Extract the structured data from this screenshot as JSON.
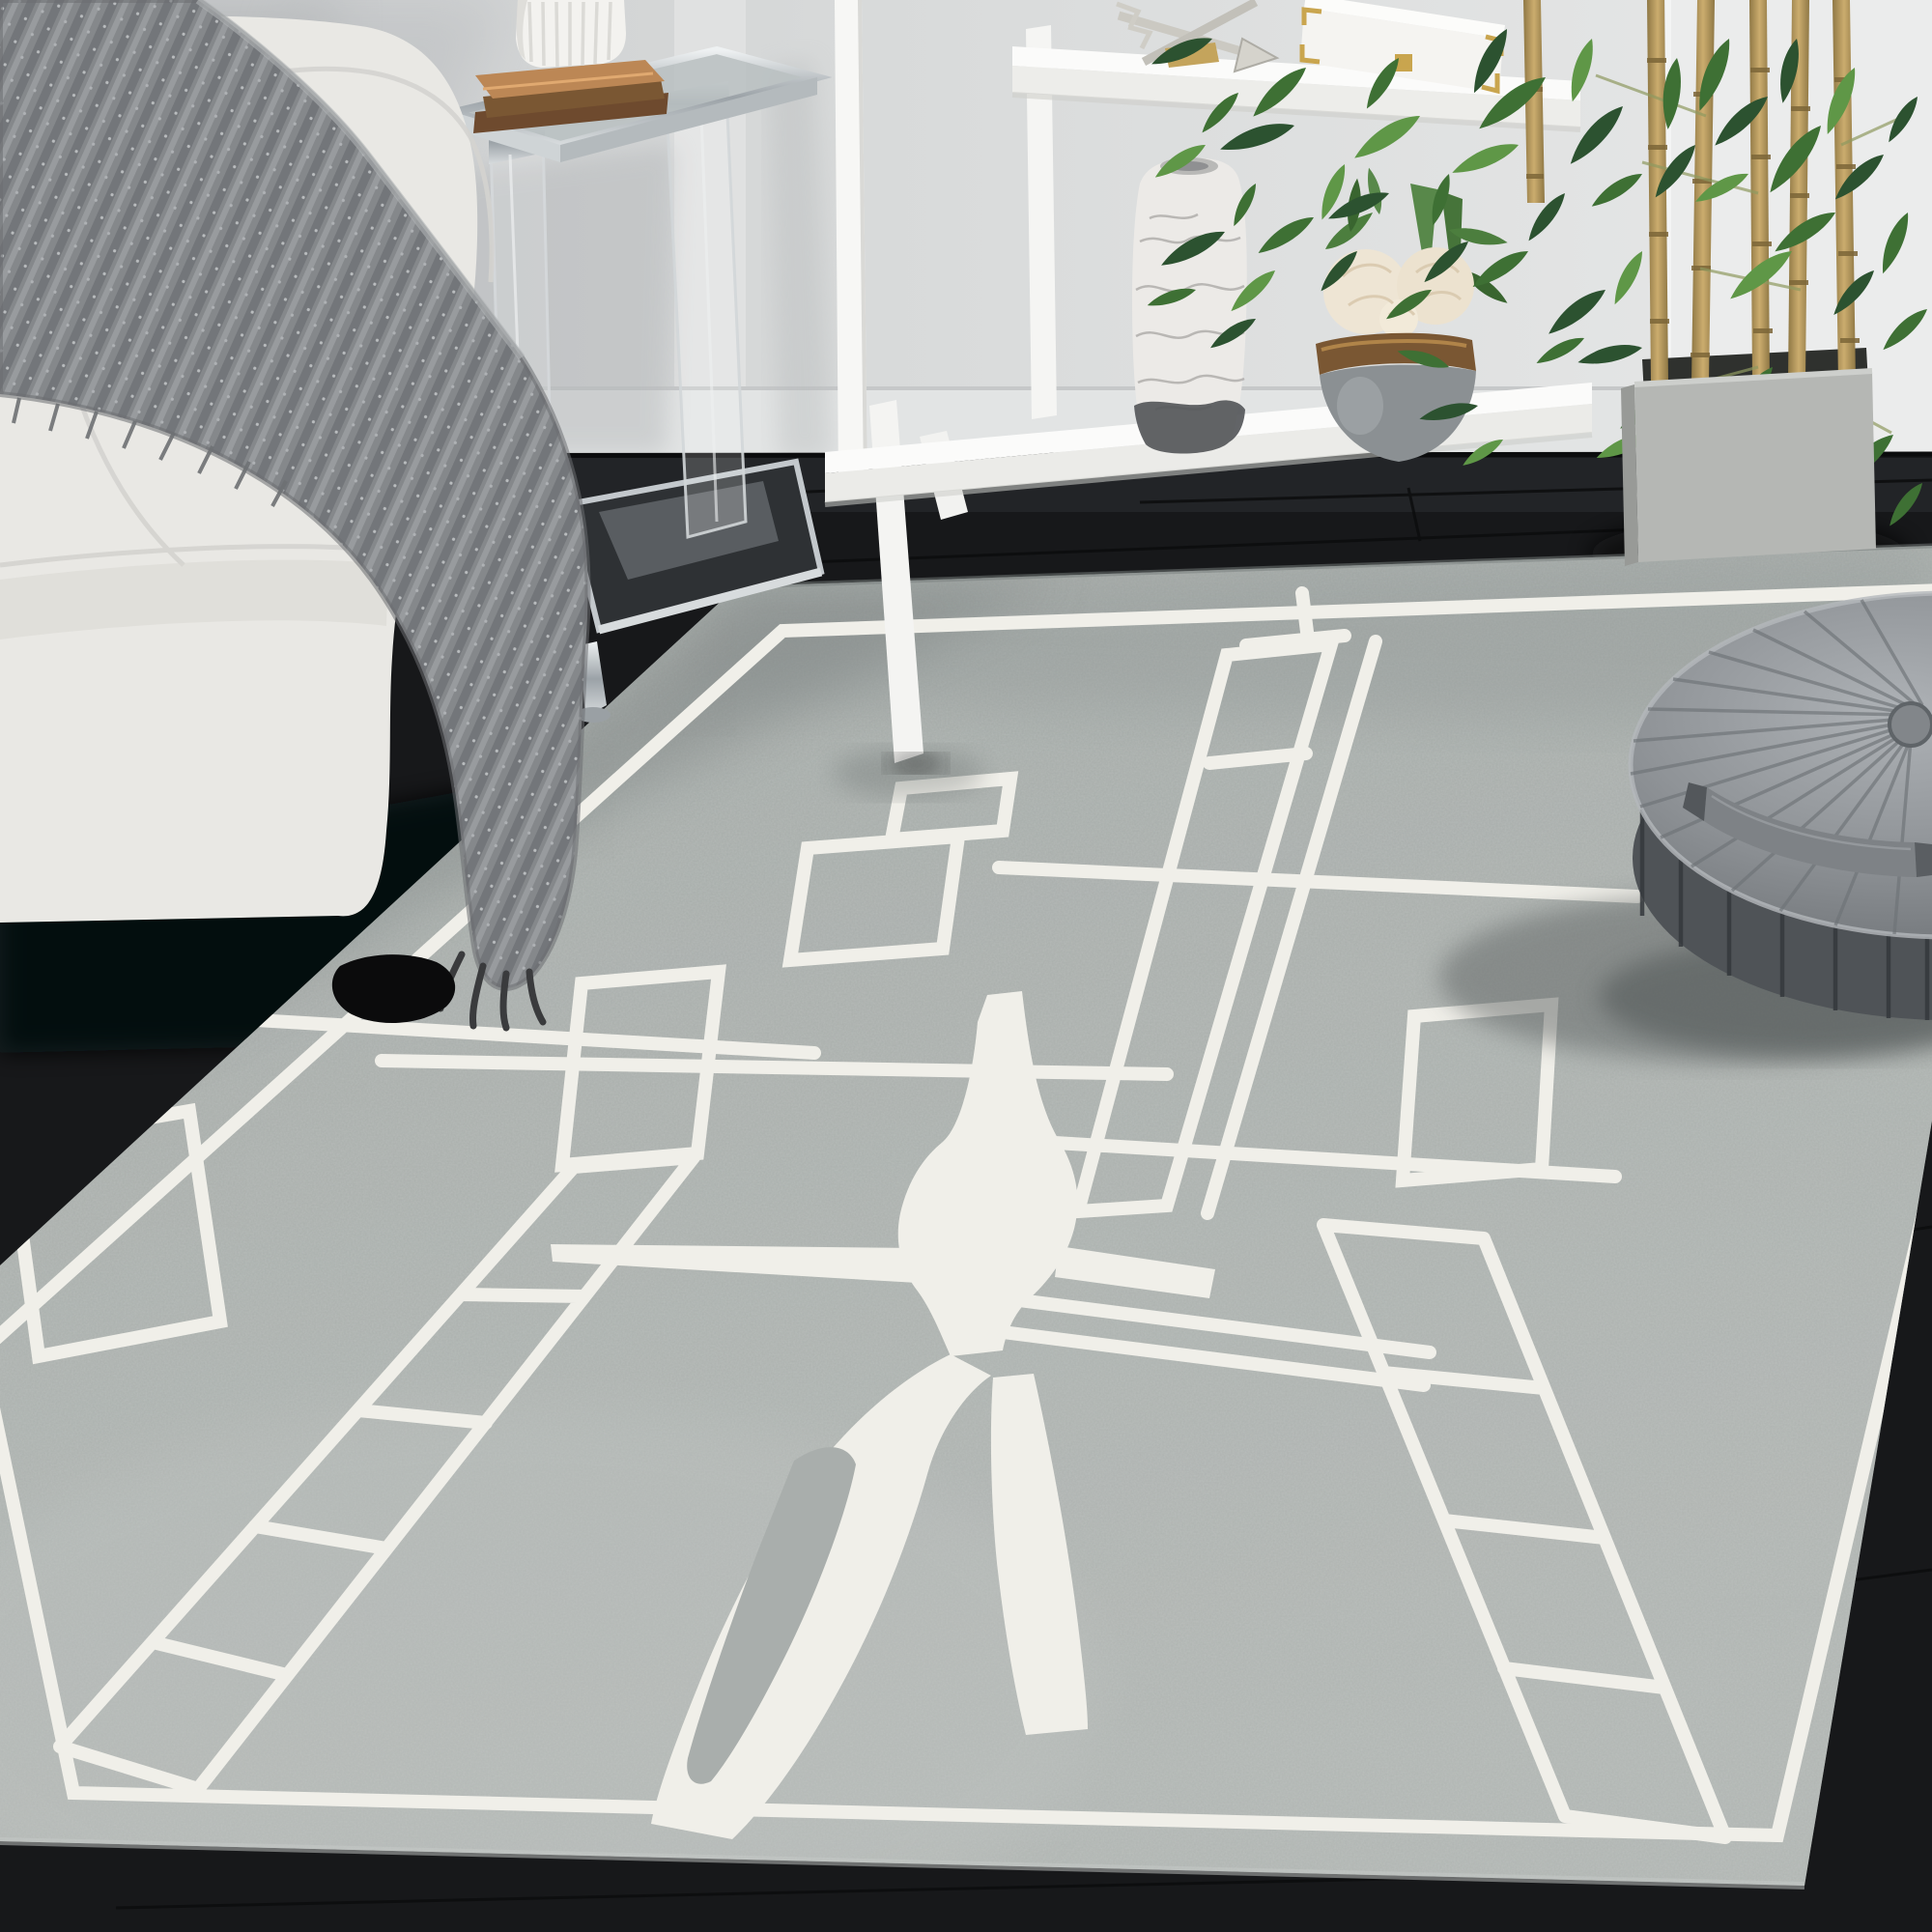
{
  "image_type": "photograph",
  "scene": {
    "description": "Bright living room corner: white boucle sofa with gray knit throw, acrylic chrome side table with white fluted vase on copper books, white ladder shelf with marble vase and peony bowl, bamboo plant in gray cube planter, gray velvet round pouf, all on a gray hand-tufted rug with white abstract runway pattern over dark wood flooring.",
    "room": "living room"
  },
  "colors": {
    "wall": "#d6d8d9",
    "wall_bright": "#ebecec",
    "baseboard": "#e2e4e4",
    "floor": "#17181a",
    "rug_base": "#a9aeac",
    "rug_pattern": "#f0efe9",
    "sofa": "#e9e8e4",
    "blanket": "#8a8d90",
    "pouf_top": "#9b9fa3",
    "pouf_side": "#4f5357",
    "planter": "#b5b7b4",
    "bamboo_stalk": "#b8995e",
    "leaf_dark": "#2c5230",
    "leaf_mid": "#3e7034",
    "leaf_light": "#5f9747",
    "shelf": "#f7f7f5",
    "chrome": "#c9ced2",
    "glass": "#b9bfc1",
    "marble_vase": "#eceae7",
    "vase_bottom": "#55575a",
    "bronze": "#7a5733",
    "copper_book": "#bc8755",
    "peony": "#eee5d4",
    "bowl": "#8b9093"
  },
  "objects": [
    {
      "id": "sofa",
      "label": "white boucle sofa with gray knit throw"
    },
    {
      "id": "side-table",
      "label": "acrylic and chrome side table"
    },
    {
      "id": "flute-vase",
      "label": "white fluted vase"
    },
    {
      "id": "copper-book",
      "label": "copper decorative books"
    },
    {
      "id": "shelf-unit",
      "label": "white ladder display shelf"
    },
    {
      "id": "arrow-sculpture",
      "label": "silver crossed-arrows decor"
    },
    {
      "id": "decor-box",
      "label": "white keepsake box with gold corners"
    },
    {
      "id": "marble-vase",
      "label": "white marble vase"
    },
    {
      "id": "flower-bowl",
      "label": "gray bowl with cream peonies"
    },
    {
      "id": "bamboo-plant",
      "label": "bamboo plant"
    },
    {
      "id": "concrete-planter",
      "label": "gray concrete cube planter"
    },
    {
      "id": "area-rug",
      "label": "gray rug with white abstract pattern"
    },
    {
      "id": "floor-pouf",
      "label": "gray velvet round pouf"
    }
  ]
}
